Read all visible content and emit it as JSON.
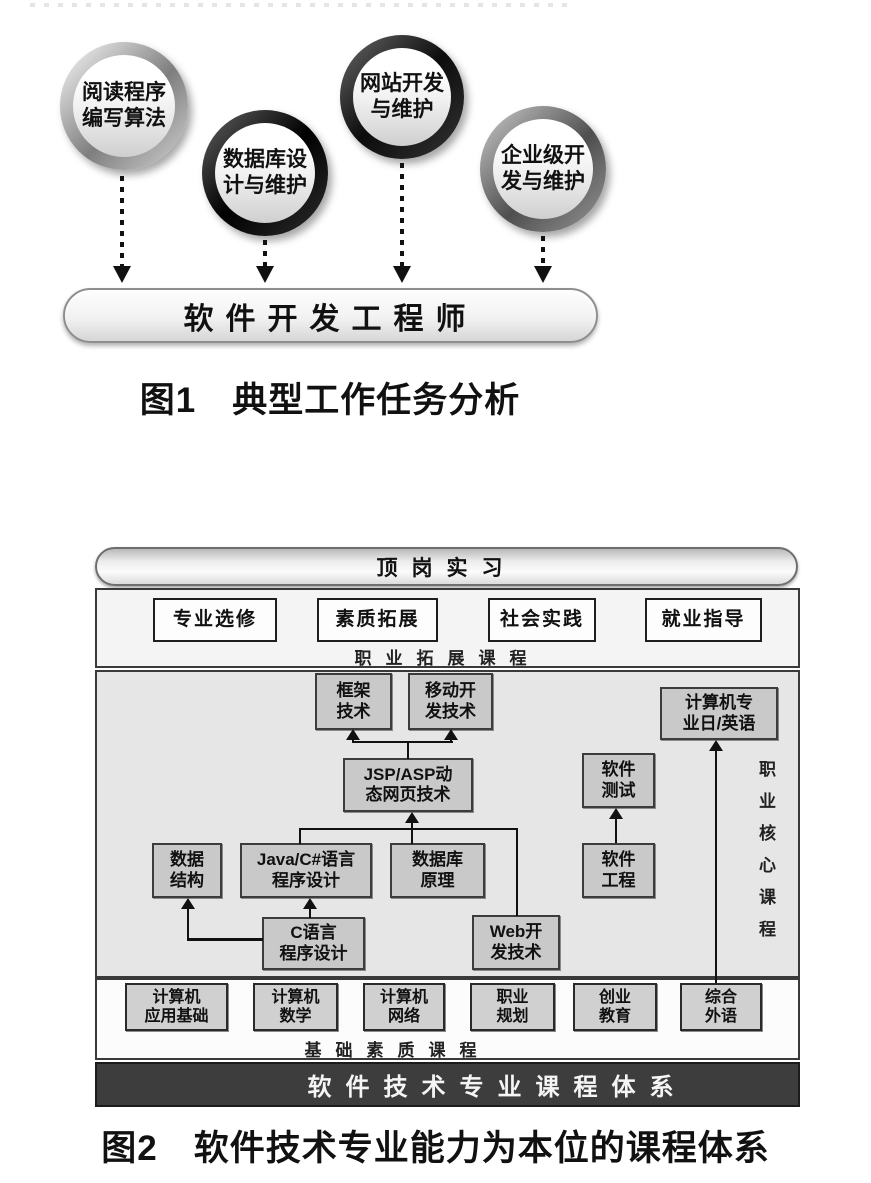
{
  "colors": {
    "line": "#111111",
    "core_box_fill": "#c9c9c9",
    "section_fill": "#e6e6e6",
    "dark_bar": "#3d3d3d"
  },
  "figure1": {
    "tasks": [
      {
        "label": "阅读程序编写算法",
        "lines": [
          "阅读程序",
          "编写算法"
        ]
      },
      {
        "label": "数据库设计与维护",
        "lines": [
          "数据库设",
          "计与维护"
        ]
      },
      {
        "label": "网站开发与维护",
        "lines": [
          "网站开发",
          "与维护"
        ]
      },
      {
        "label": "企业级开发与维护",
        "lines": [
          "企业级开",
          "发与维护"
        ]
      }
    ],
    "role": "软件开发工程师",
    "caption": "图1　典型工作任务分析"
  },
  "figure2": {
    "internship": "顶岗实习",
    "extension": {
      "label": "职业拓展课程",
      "courses": [
        {
          "label": "专业选修"
        },
        {
          "label": "素质拓展"
        },
        {
          "label": "社会实践"
        },
        {
          "label": "就业指导"
        }
      ]
    },
    "core": {
      "label": "职业核心课程",
      "framework": {
        "label": "框架技术",
        "lines": [
          "框架",
          "技术"
        ]
      },
      "mobile": {
        "label": "移动开发技术",
        "lines": [
          "移动开",
          "发技术"
        ]
      },
      "jsp": {
        "label": "JSP/ASP动态网页技术",
        "lines": [
          "JSP/ASP动",
          "态网页技术"
        ]
      },
      "data_structure": {
        "label": "数据结构",
        "lines": [
          "数据",
          "结构"
        ]
      },
      "java": {
        "label": "Java/C#语言程序设计",
        "lines": [
          "Java/C#语言",
          "程序设计"
        ]
      },
      "database": {
        "label": "数据库原理",
        "lines": [
          "数据库",
          "原理"
        ]
      },
      "c_language": {
        "label": "C语言程序设计",
        "lines": [
          "C语言",
          "程序设计"
        ]
      },
      "web": {
        "label": "Web开发技术",
        "lines": [
          "Web开",
          "发技术"
        ]
      },
      "testing": {
        "label": "软件测试",
        "lines": [
          "软件",
          "测试"
        ]
      },
      "engineering": {
        "label": "软件工程",
        "lines": [
          "软件",
          "工程"
        ]
      },
      "cs_language": {
        "label": "计算机专业日/英语",
        "lines": [
          "计算机专",
          "业日/英语"
        ]
      }
    },
    "foundation": {
      "label": "基础素质课程",
      "courses": [
        {
          "label": "计算机应用基础",
          "lines": [
            "计算机",
            "应用基础"
          ]
        },
        {
          "label": "计算机数学",
          "lines": [
            "计算机",
            "数学"
          ]
        },
        {
          "label": "计算机网络",
          "lines": [
            "计算机",
            "网络"
          ]
        },
        {
          "label": "职业规划",
          "lines": [
            "职业",
            "规划"
          ]
        },
        {
          "label": "创业教育",
          "lines": [
            "创业",
            "教育"
          ]
        },
        {
          "label": "综合外语",
          "lines": [
            "综合",
            "外语"
          ]
        }
      ]
    },
    "system_bar": "软件技术专业课程体系",
    "caption": "图2　软件技术专业能力为本位的课程体系"
  }
}
